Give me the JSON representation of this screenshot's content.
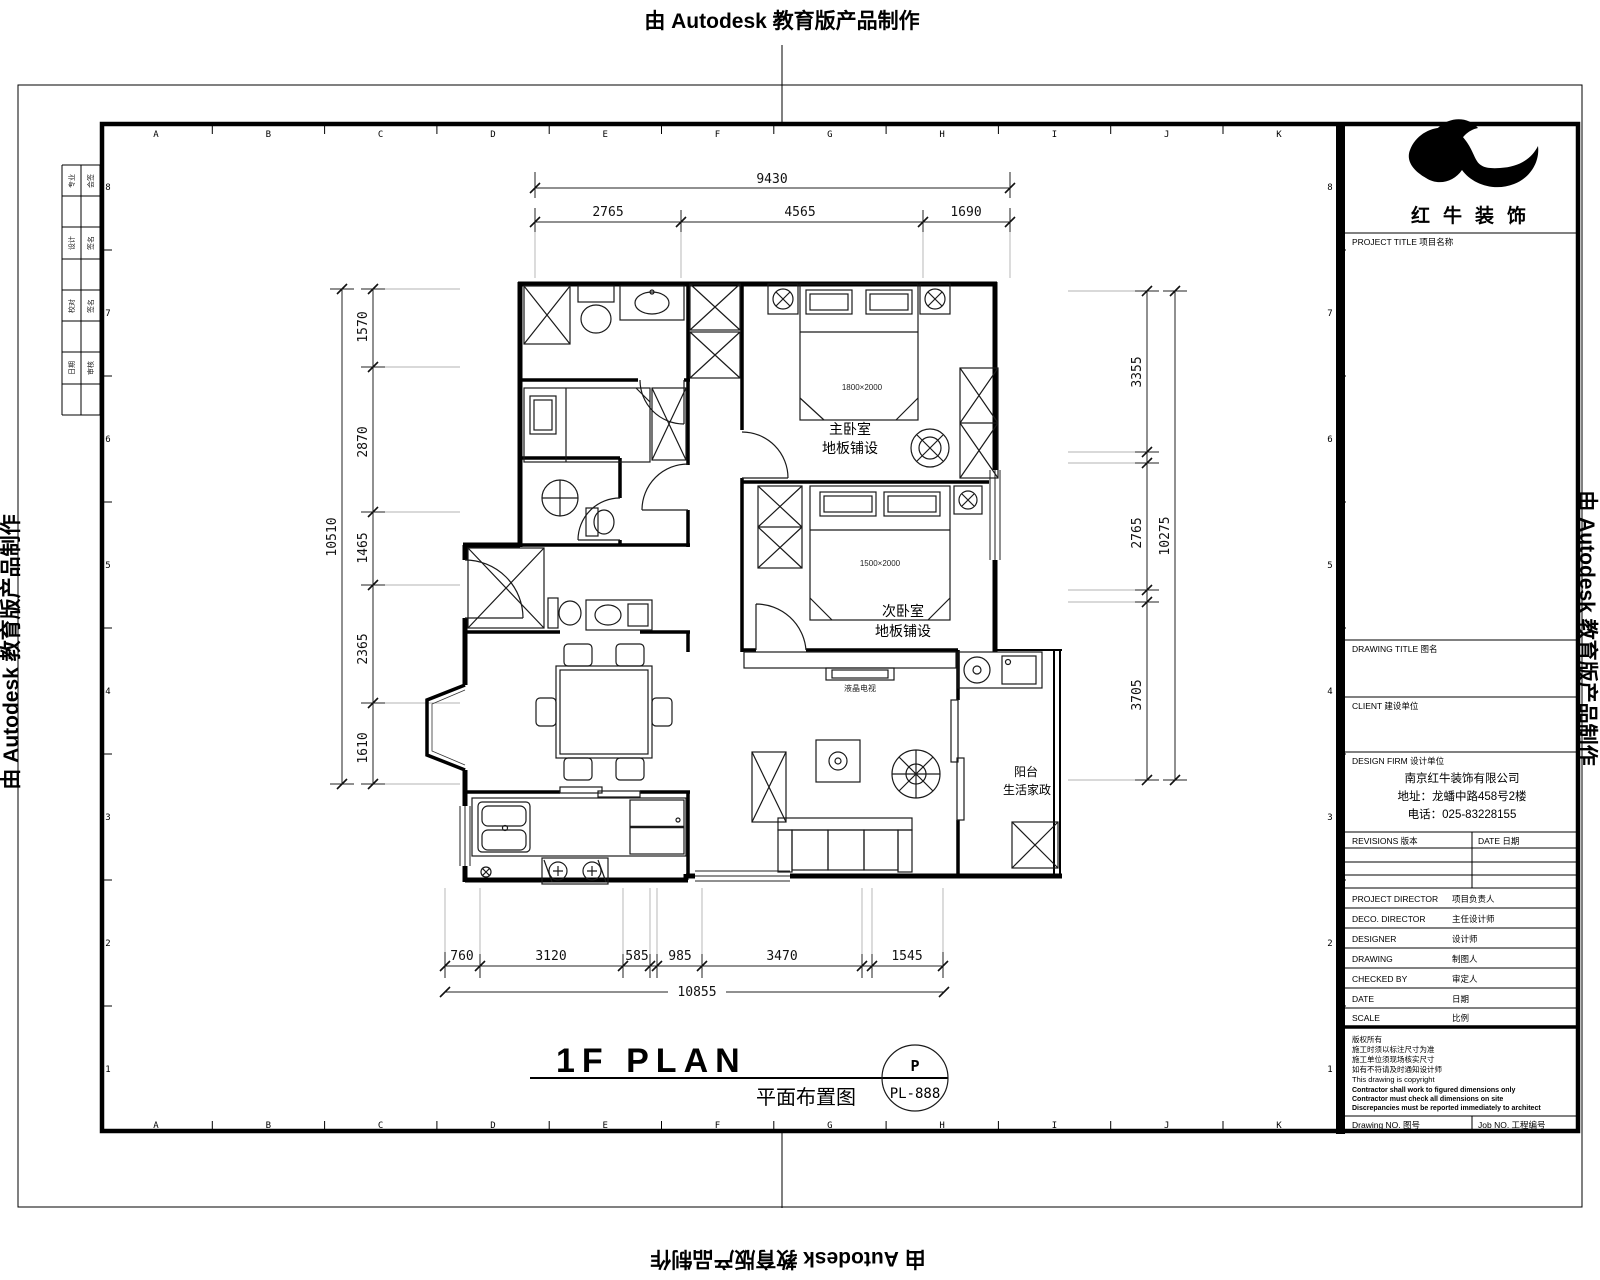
{
  "watermark": {
    "text": "由 Autodesk 教育版产品制作"
  },
  "sheet": {
    "grid_letters": [
      "A",
      "B",
      "C",
      "D",
      "E",
      "F",
      "G",
      "H",
      "I",
      "J",
      "K"
    ],
    "grid_numbers": [
      "8",
      "7",
      "6",
      "5",
      "4",
      "3",
      "2",
      "1"
    ],
    "signature_table": {
      "rows": [
        [
          "专业",
          "会签"
        ],
        [
          "设计",
          "签名"
        ],
        [
          "校对",
          "签名"
        ],
        [
          "日期",
          "审核"
        ]
      ]
    }
  },
  "plan": {
    "rooms": {
      "master_bedroom": {
        "name": "主卧室",
        "finish": "地板铺设",
        "bed_size": "1800×2000"
      },
      "second_bedroom": {
        "name": "次卧室",
        "finish": "地板铺设",
        "bed_size": "1500×2000"
      },
      "balcony": {
        "name": "阳台",
        "finish": "生活家政"
      },
      "tv_label": "液晶电视"
    },
    "dims": {
      "top": {
        "overall": "9430",
        "segs": [
          "2765",
          "4565",
          "1690"
        ]
      },
      "left": {
        "overall": "10510",
        "segs": [
          "1570",
          "2870",
          "1465",
          "2365",
          "1610"
        ]
      },
      "right": {
        "overall": "10275",
        "segs": [
          "3355",
          "2765",
          "3705"
        ]
      },
      "bottom": {
        "overall": "10855",
        "segs": [
          "760",
          "3120",
          "585",
          "985",
          "3470",
          "1545"
        ]
      }
    },
    "title": {
      "main": "1F PLAN",
      "sub": "平面布置图",
      "badge_top": "P",
      "badge_bottom": "PL-888"
    }
  },
  "titleblock": {
    "brand": "红牛装饰",
    "project_label": "PROJECT TITLE 项目名称",
    "drawing_title_label": "DRAWING TITLE 图名",
    "client_label": "CLIENT 建设单位",
    "design_firm_label": "DESIGN FIRM 设计单位",
    "firm_name": "南京红牛装饰有限公司",
    "firm_address": "地址：龙蟠中路458号2楼",
    "firm_phone": "电话：025-83228155",
    "revisions_label": "REVISIONS 版本",
    "date_col_label": "DATE 日期",
    "staff_rows": [
      {
        "label": "PROJECT DIRECTOR",
        "cn": "项目负责人"
      },
      {
        "label": "DECO. DIRECTOR",
        "cn": "主任设计师"
      },
      {
        "label": "DESIGNER",
        "cn": "设计师"
      },
      {
        "label": "DRAWING",
        "cn": "制图人"
      },
      {
        "label": "CHECKED BY",
        "cn": "审定人"
      },
      {
        "label": "DATE",
        "cn": "日期"
      },
      {
        "label": "SCALE",
        "cn": "比例"
      }
    ],
    "notes": [
      "版权所有",
      "施工时须以标注尺寸为准",
      "施工单位须现场核实尺寸",
      "如有不符请及时通知设计师",
      "This drawing is copyright",
      "Contractor shall work to figured dimensions only",
      "Contractor must check all dimensions on site",
      "Discrepancies must be reported immediately to architect"
    ],
    "drawing_no_label": "Drawing NO. 图号",
    "job_no_label": "Job NO. 工程编号"
  }
}
